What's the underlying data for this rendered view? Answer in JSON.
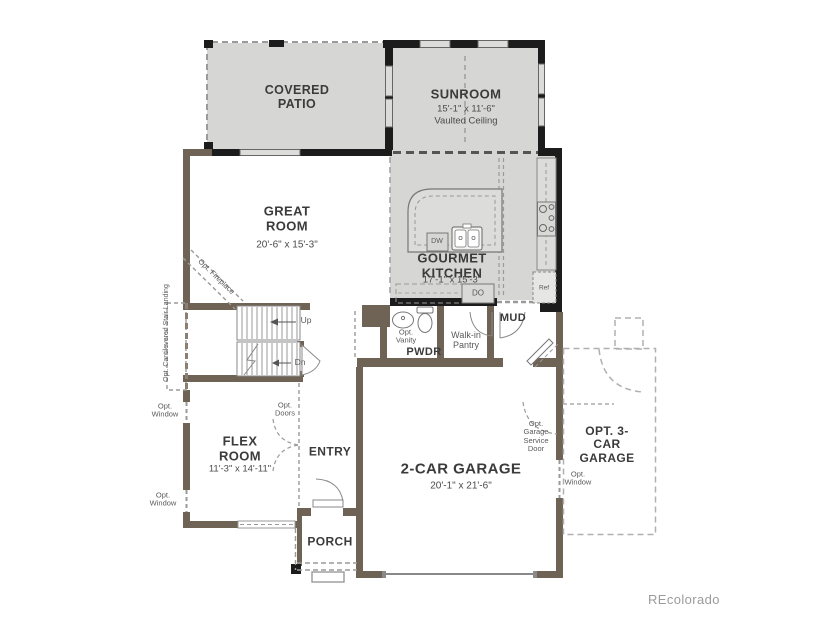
{
  "palette": {
    "structure_fill": "#d6d6d4",
    "optional_structure_wall": "#1c1c1c",
    "main_wall": "#6f6355",
    "fixture_line": "#8a8a8a",
    "watermark_color": "#9b9b9b"
  },
  "watermark": "REcolorado",
  "rooms": {
    "covered_patio": {
      "name": "COVERED PATIO"
    },
    "sunroom": {
      "name": "SUNROOM",
      "dims": "15'-1\" x 11'-6\"",
      "note": "Vaulted Ceiling"
    },
    "great_room": {
      "name": "GREAT ROOM",
      "dims": "20'-6\" x 15'-3\""
    },
    "gourmet_kitchen": {
      "name": "GOURMET KITCHEN",
      "dims": "17'-1\" x 15'-3\""
    },
    "pwdr": {
      "name": "PWDR"
    },
    "walk_in_pantry": {
      "name": "Walk-in Pantry"
    },
    "mud": {
      "name": "MUD"
    },
    "flex_room": {
      "name": "FLEX ROOM",
      "dims": "11'-3\" x 14'-11\""
    },
    "entry": {
      "name": "ENTRY"
    },
    "porch": {
      "name": "PORCH"
    },
    "garage": {
      "name": "2-CAR GARAGE",
      "dims": "20'-1\" x 21'-6\""
    },
    "opt_garage": {
      "name": "OPT. 3-CAR GARAGE"
    }
  },
  "annotations": {
    "opt_fireplace": "Opt. Fireplace",
    "opt_cantilevered_stair_landing": "Opt. Cantilevered Stair Landing",
    "opt_window": "Opt. Window",
    "opt_doors": "Opt. Doors",
    "opt_vanity": "Opt. Vanity",
    "opt_garage_service_door": "Opt. Garage Service Door",
    "up": "Up",
    "dn": "Dn",
    "dw": "DW",
    "do": "DO",
    "ref": "Ref"
  }
}
